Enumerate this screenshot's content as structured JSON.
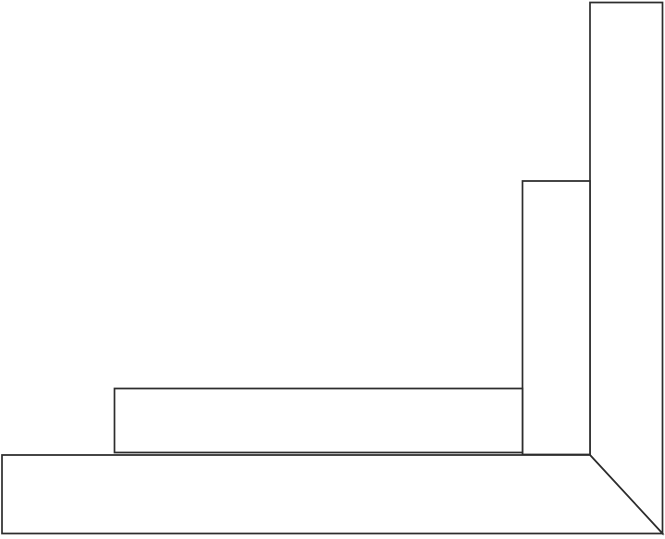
{
  "canvas": {
    "width": 665,
    "height": 539,
    "background": "#ffffff",
    "line_color": "#2d2d2d",
    "line_width": 1.7,
    "shape_fill": "#ffffff",
    "view_box": "0 0 665 539"
  },
  "diagram": {
    "kind": "line-drawing",
    "subject": "mitered-corner-joint",
    "shapes": [
      {
        "name": "vertical-board",
        "type": "polygon",
        "points": "590,2.5 662.5,2.5 662.5,533.5 590,455"
      },
      {
        "name": "vertical-board-inner-lip",
        "type": "polygon",
        "points": "522.5,181 590,181 590,454.5 522.5,454.5"
      },
      {
        "name": "horizontal-board",
        "type": "polygon",
        "points": "2,455 590,455 662.5,533.5 2,533.5"
      },
      {
        "name": "horizontal-board-inner-lip",
        "type": "polygon",
        "points": "114.5,388.5 522.5,388.5 522.5,452.5 114.5,452.5"
      }
    ]
  }
}
